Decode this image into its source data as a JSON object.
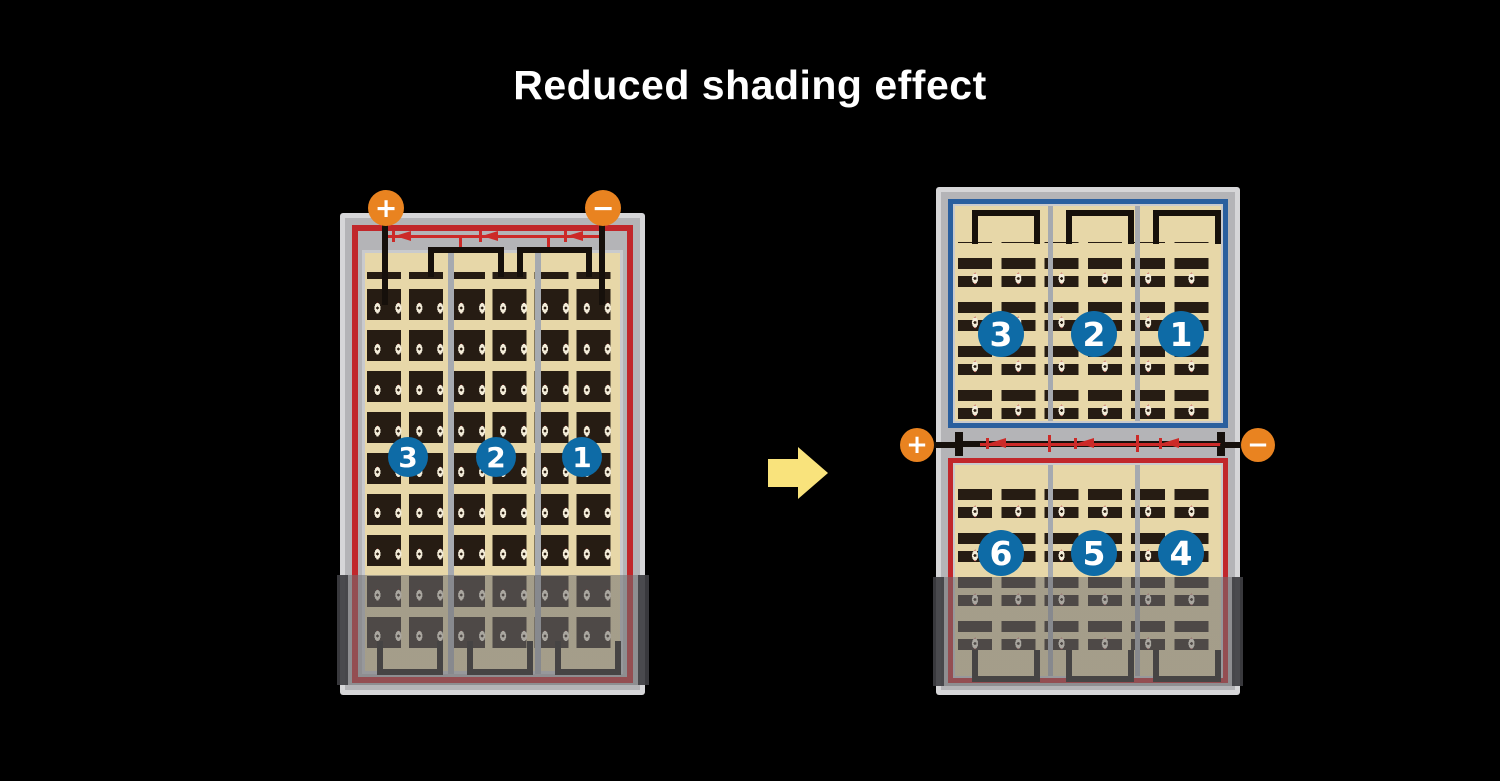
{
  "title": "Reduced shading effect",
  "colors": {
    "background": "#000000",
    "frame_rim": "#d6d6d8",
    "frame_gray": "#b4b4b7",
    "panel_cream": "#e7d7a8",
    "cell_dark": "#261c13",
    "divider_gray": "#a6aab0",
    "lining_gray": "#c9cacd",
    "border_red": "#c1272b",
    "border_red2": "#c1272b",
    "border_blue": "#2a5f9e",
    "diode_red": "#cc2a28",
    "wire_black": "#16100b",
    "terminal_orange": "#e98320",
    "string_blue": "#0e6ba6",
    "label_white": "#ffffff",
    "arrow_yellow": "#f9e37c",
    "shade_dark": "rgba(110,110,114,0.55)",
    "shade_edge": "rgba(62,62,66,0.92)"
  },
  "left_module": {
    "terminal_positive": "+",
    "terminal_negative": "−",
    "strings": [
      {
        "label": "3"
      },
      {
        "label": "2"
      },
      {
        "label": "1"
      }
    ]
  },
  "right_module": {
    "terminal_positive": "+",
    "terminal_negative": "−",
    "top_half_strings": [
      {
        "label": "3"
      },
      {
        "label": "2"
      },
      {
        "label": "1"
      }
    ],
    "bottom_half_strings": [
      {
        "label": "6"
      },
      {
        "label": "5"
      },
      {
        "label": "4"
      }
    ]
  }
}
